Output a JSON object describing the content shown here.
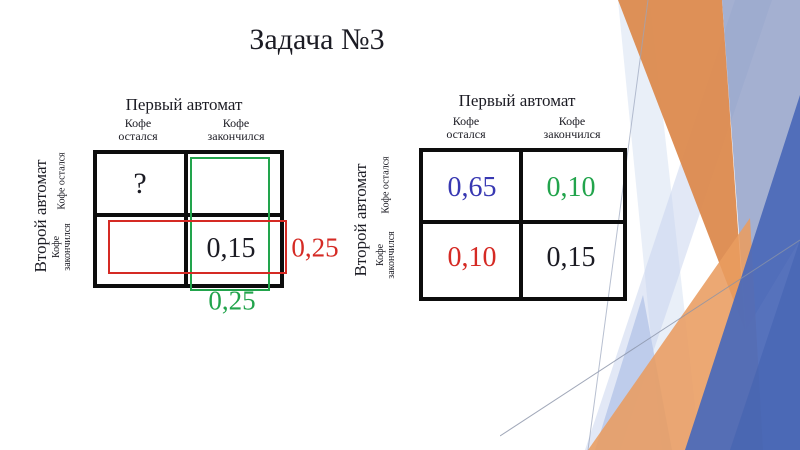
{
  "slide_title": "Задача №3",
  "colors": {
    "red": "#d52a24",
    "green": "#22a44c",
    "blue": "#3838b2",
    "black": "#1c1c24"
  },
  "left_table": {
    "top_axis_label": "Первый автомат",
    "side_axis_label": "Второй автомат",
    "col_headers": [
      "Кофе остался",
      "Кофе закончился"
    ],
    "row_headers": [
      "Кофе остался",
      "Кофе закончился"
    ],
    "cells": [
      [
        "?",
        ""
      ],
      [
        "",
        "0,15"
      ]
    ],
    "row_sum_label": "0,25",
    "col_sum_label": "0,25"
  },
  "right_table": {
    "top_axis_label": "Первый автомат",
    "side_axis_label": "Второй автомат",
    "col_headers": [
      "Кофе остался",
      "Кофе закончился"
    ],
    "row_headers": [
      "Кофе остался",
      "Кофе закончился"
    ],
    "cells": [
      [
        "0,65",
        "0,10"
      ],
      [
        "0,10",
        "0,15"
      ]
    ]
  }
}
